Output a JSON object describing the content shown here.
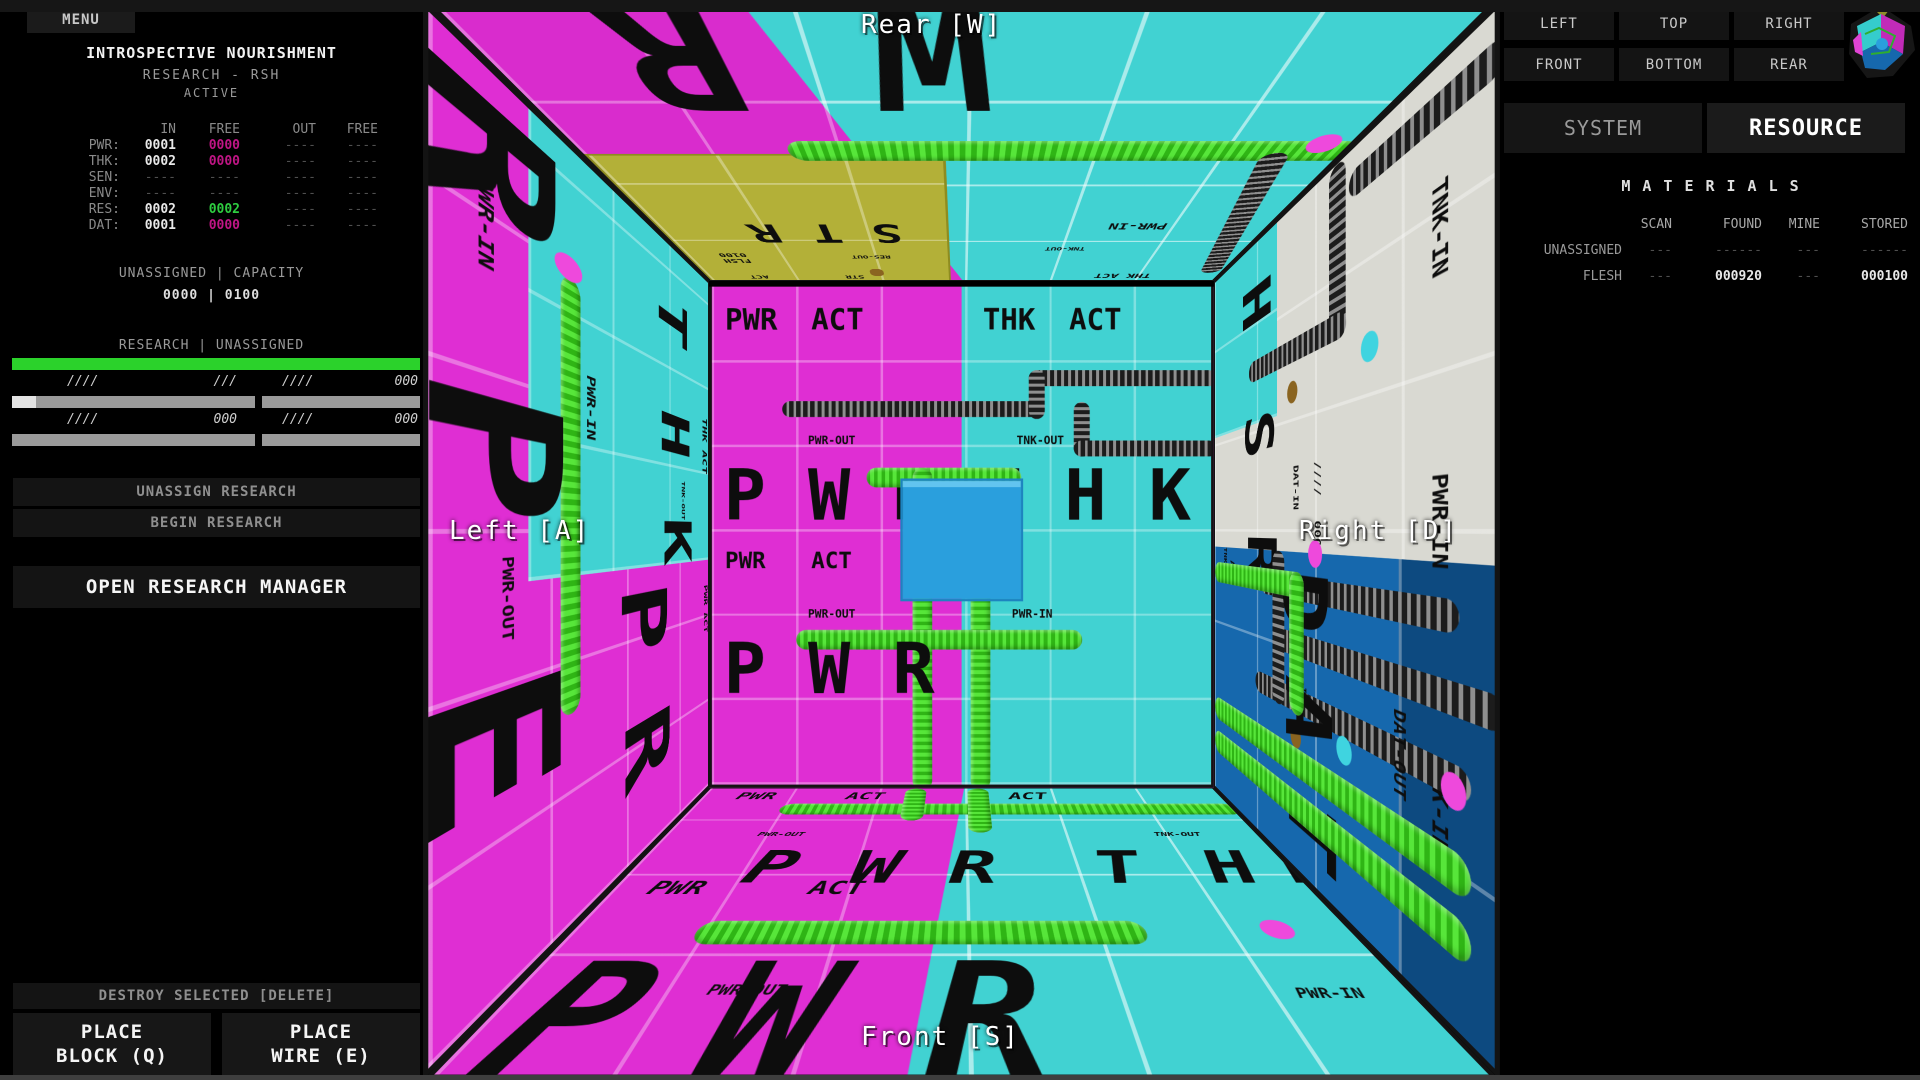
{
  "left_panel": {
    "menu": "MENU",
    "title": "INTROSPECTIVE NOURISHMENT",
    "subtitle": "RESEARCH - RSH",
    "status": "ACTIVE",
    "io_table": {
      "col_headers": [
        "IN",
        "FREE",
        "OUT",
        "FREE"
      ],
      "rows": [
        {
          "label": "PWR:",
          "in": "0001",
          "in_free": "0000",
          "out": "----",
          "out_free": "----"
        },
        {
          "label": "THK:",
          "in": "0002",
          "in_free": "0000",
          "out": "----",
          "out_free": "----"
        },
        {
          "label": "SEN:",
          "in": "----",
          "in_free": "----",
          "out": "----",
          "out_free": "----"
        },
        {
          "label": "ENV:",
          "in": "----",
          "in_free": "----",
          "out": "----",
          "out_free": "----"
        },
        {
          "label": "RES:",
          "in": "0002",
          "in_free": "0002",
          "out": "----",
          "out_free": "----"
        },
        {
          "label": "DAT:",
          "in": "0001",
          "in_free": "0000",
          "out": "----",
          "out_free": "----"
        }
      ],
      "value_colors": {
        "magenta": "#c01585",
        "green": "#2ecc40"
      }
    },
    "capacity": {
      "label": "UNASSIGNED | CAPACITY",
      "value": "0000 | 0100"
    },
    "research": {
      "label": "RESEARCH | UNASSIGNED",
      "bar_color": "#2bd22b",
      "meters": [
        {
          "left": "////",
          "right": "///",
          "fill_percent": 10
        },
        {
          "left": "////",
          "right": "000",
          "fill_percent": 0
        },
        {
          "left": "////",
          "right": "000",
          "fill_percent": 0
        },
        {
          "left": "////",
          "right": "000",
          "fill_percent": 0
        }
      ]
    },
    "buttons": {
      "unassign": "UNASSIGN RESEARCH",
      "begin": "BEGIN RESEARCH",
      "open_manager": "OPEN RESEARCH MANAGER",
      "destroy": "DESTROY SELECTED [DELETE]",
      "place_block_line1": "PLACE",
      "place_block_line2": "BLOCK (Q)",
      "place_wire_line1": "PLACE",
      "place_wire_line2": "WIRE (E)"
    }
  },
  "viewport": {
    "overlay_labels": {
      "rear": "Rear [W]",
      "left": "Left [A]",
      "right": "Right [D]",
      "front": "Front [S]"
    },
    "rear_wall": {
      "row_top": [
        "PWR",
        "ACT",
        "THK",
        "ACT"
      ],
      "row_mid": [
        "PWR",
        "ACT"
      ],
      "pwr_out": "PWR-OUT",
      "tnk_out": "TNK-OUT",
      "pwr_in": "PWR-IN",
      "big_left": [
        "P",
        "W",
        "R"
      ],
      "big_right": [
        "T",
        "H",
        "K"
      ]
    },
    "floor": {
      "edge_labels": [
        "PWR",
        "ACT",
        "ACT"
      ],
      "mid_labels": [
        "PWR",
        "ACT"
      ],
      "pwr_out": "PWR-OUT",
      "tnk_out": "TNK-OUT",
      "pwr_in": "PWR-IN",
      "big": [
        "P",
        "W",
        "R",
        "T",
        "H",
        "K"
      ],
      "big_near": [
        "P",
        "W",
        "R"
      ]
    },
    "ceiling": {
      "str_block": {
        "big": "STR",
        "flsh": "FLSH",
        "code": "0100",
        "res_out": "RES-OUT",
        "act": "ACT",
        "str": "STR"
      },
      "pwr_in": "PWR-IN",
      "thk_act": "THK ACT",
      "tnk_out": "TNK-OUT",
      "big_near": [
        "R",
        "W"
      ]
    },
    "left_wall": {
      "big_cyan": [
        "T",
        "H",
        "K"
      ],
      "pwr_in": "PWR-IN",
      "thk_act": "THK ACT",
      "tnk_out": "TNK-OUT",
      "pwr_out": "PWR-OUT",
      "pwr_act": "PWR ACT",
      "big_near": [
        "R",
        "P",
        "E"
      ],
      "big_magenta": [
        "P",
        "R"
      ]
    },
    "right_wall": {
      "big_white": [
        "H",
        "S",
        "R"
      ],
      "tnk_in": "TNK-IN",
      "pwr_in": "PWR-IN",
      "dat_in": "DAT-IN",
      "slashes": "////",
      "zeros": "000",
      "in_suffix": "-IN",
      "big_blue": [
        "D",
        "A",
        "T"
      ],
      "dat_out": "DAT-OUT",
      "act": "ACT"
    },
    "colors": {
      "magenta_wall": "#df2ed3",
      "cyan_wall": "#41d2d2",
      "white_wall": "#d9d9d2",
      "blue_wall": "#1668ad",
      "yellow_block": "#b3b038",
      "selected_block": "#2a9fdd",
      "wire_green": "#44dd22"
    }
  },
  "right_panel": {
    "view_buttons": [
      "LEFT",
      "TOP",
      "RIGHT",
      "FRONT",
      "BOTTOM",
      "REAR"
    ],
    "tabs": {
      "system": "SYSTEM",
      "resource": "RESOURCE"
    },
    "materials": {
      "title": "MATERIALS",
      "col_headers": [
        "SCAN",
        "FOUND",
        "MINE",
        "STORED"
      ],
      "rows": [
        {
          "label": "UNASSIGNED",
          "scan": "---",
          "found": "------",
          "mine": "---",
          "stored": "------"
        },
        {
          "label": "FLESH",
          "scan": "---",
          "found": "000920",
          "mine": "---",
          "stored": "000100"
        }
      ]
    }
  }
}
